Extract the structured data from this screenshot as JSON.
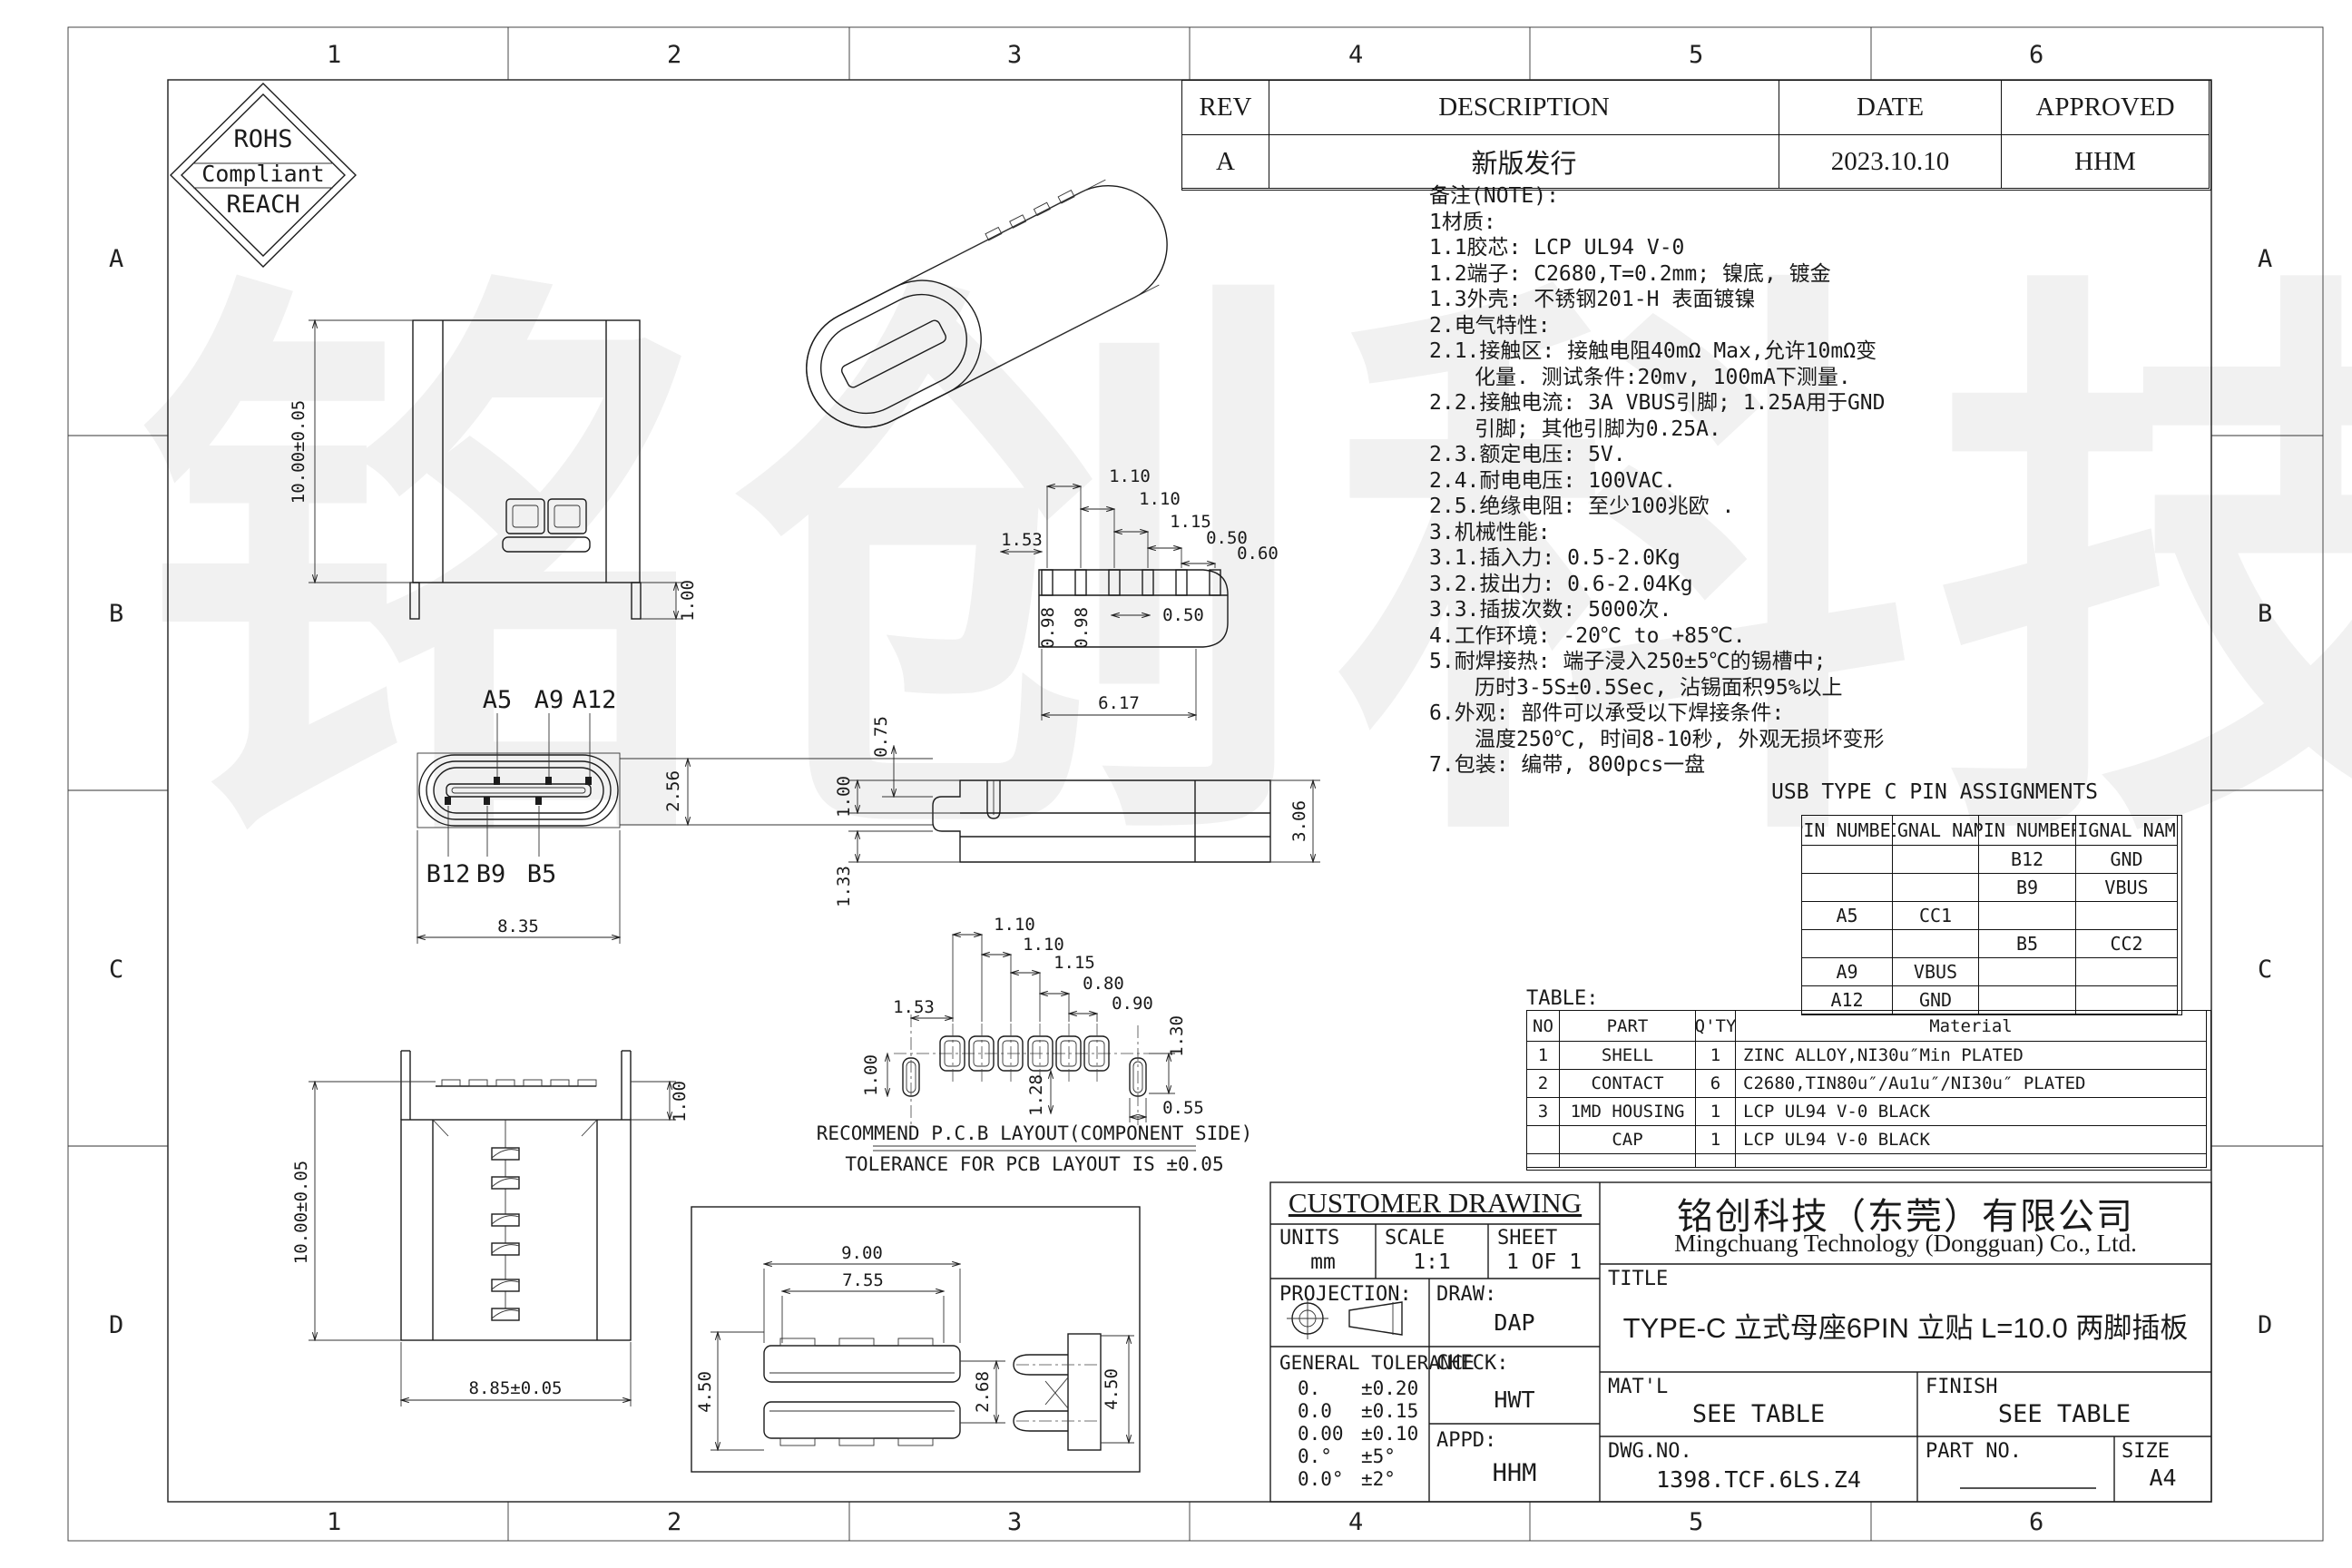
{
  "watermark": "铭创科技",
  "border": {
    "cols": [
      "1",
      "2",
      "3",
      "4",
      "5",
      "6"
    ],
    "rows": [
      "A",
      "B",
      "C",
      "D"
    ]
  },
  "logo": {
    "line1": "ROHS",
    "line2": "Compliant",
    "line3": "REACH"
  },
  "rev_table": {
    "headers": [
      "REV",
      "DESCRIPTION",
      "DATE",
      "APPROVED"
    ],
    "row": {
      "rev": "A",
      "description": "新版发行",
      "date": "2023.10.10",
      "approved": "HHM"
    }
  },
  "notes": {
    "lines": [
      "备注(NOTE):",
      "1材质:",
      "1.1胶芯: LCP UL94 V-0",
      "1.2端子: C2680,T=0.2mm; 镍底, 镀金",
      "1.3外壳: 不锈钢201-H 表面镀镍",
      "2.电气特性:",
      "2.1.接触区: 接触电阻40mΩ Max,允许10mΩ变",
      "化量. 测试条件:20mv, 100mA下测量.",
      "2.2.接触电流: 3A VBUS引脚; 1.25A用于GND",
      "引脚; 其他引脚为0.25A.",
      "2.3.额定电压: 5V.",
      "2.4.耐电电压: 100VAC.",
      "2.5.绝缘电阻: 至少100兆欧 .",
      "3.机械性能:",
      "3.1.插入力: 0.5-2.0Kg",
      "3.2.拔出力: 0.6-2.04Kg",
      "3.3.插拔次数: 5000次.",
      "4.工作环境: -20℃ to +85℃.",
      "5.耐焊接热: 端子浸入250±5℃的锡槽中;",
      "历时3-5S±0.5Sec, 沾锡面积95%以上",
      "6.外观: 部件可以承受以下焊接条件:",
      "温度250℃, 时间8-10秒, 外观无损坏变形",
      "7.包装: 编带, 800pcs一盘"
    ]
  },
  "pin_table": {
    "title": "USB TYPE C PIN ASSIGNMENTS",
    "headers": [
      "PIN NUMBER",
      "SIGNAL NAME",
      "PIN NUMBER",
      "SIGNAL NAME"
    ],
    "rows": [
      [
        "",
        "",
        "B12",
        "GND"
      ],
      [
        "",
        "",
        "B9",
        "VBUS"
      ],
      [
        "A5",
        "CC1",
        "",
        ""
      ],
      [
        "",
        "",
        "B5",
        "CC2"
      ],
      [
        "A9",
        "VBUS",
        "",
        ""
      ],
      [
        "A12",
        "GND",
        "",
        ""
      ]
    ]
  },
  "material_table": {
    "label": "TABLE:",
    "headers": [
      "NO",
      "PART",
      "Q'TY",
      "Material"
    ],
    "rows": [
      [
        "1",
        "SHELL",
        "1",
        "ZINC ALLOY,NI30u″Min PLATED"
      ],
      [
        "2",
        "CONTACT",
        "6",
        "C2680,TIN80u″/Au1u″/NI30u″ PLATED"
      ],
      [
        "3",
        "1MD HOUSING",
        "1",
        "LCP UL94 V-0 BLACK"
      ],
      [
        "",
        "CAP",
        "1",
        "LCP UL94 V-0 BLACK"
      ]
    ]
  },
  "title_block": {
    "customer_drawing": "CUSTOMER DRAWING",
    "units_label": "UNITS",
    "units_value": "mm",
    "scale_label": "SCALE",
    "scale_value": "1:1",
    "sheet_label": "SHEET",
    "sheet_value": "1 OF 1",
    "projection_label": "PROJECTION:",
    "draw_label": "DRAW:",
    "draw_value": "DAP",
    "check_label": "CHECK:",
    "check_value": "HWT",
    "appd_label": "APPD:",
    "appd_value": "HHM",
    "tolerance_label": "GENERAL TOLERANCE",
    "tolerance_rows": [
      [
        "0.",
        "±0.20"
      ],
      [
        "0.0",
        "±0.15"
      ],
      [
        "0.00",
        "±0.10"
      ],
      [
        "0.°",
        "±5°"
      ],
      [
        "0.0°",
        "±2°"
      ]
    ],
    "company_cn": "铭创科技（东莞）有限公司",
    "company_en": "Mingchuang Technology (Dongguan) Co., Ltd.",
    "title_label": "TITLE",
    "title_value": "TYPE-C 立式母座6PIN 立贴 L=10.0 两脚插板",
    "matl_label": "MAT'L",
    "matl_value": "SEE TABLE",
    "finish_label": "FINISH",
    "finish_value": "SEE TABLE",
    "dwgno_label": "DWG.NO.",
    "dwgno_value": "1398.TCF.6LS.Z4",
    "partno_label": "PART NO.",
    "size_label": "SIZE",
    "size_value": "A4"
  },
  "views": {
    "elevation": {
      "height": "10.00±0.05",
      "leg": "1.00"
    },
    "bottom": {
      "d1": "1.53",
      "d2": "1.10",
      "d3": "1.10",
      "d4": "1.15",
      "d5": "0.50",
      "d6": "0.60",
      "d7": "0.98",
      "d8": "0.98",
      "d9": "0.50",
      "d10": "6.17"
    },
    "front": {
      "a1": "A5",
      "a2": "A9",
      "a3": "A12",
      "b1": "B12",
      "b2": "B9",
      "b3": "B5",
      "w": "8.35",
      "h": "2.56"
    },
    "side": {
      "d1": "1.00",
      "d2": "0.75",
      "d3": "1.33",
      "d4": "3.06"
    },
    "pcb": {
      "d1": "1.53",
      "d2": "1.10",
      "d3": "1.10",
      "d4": "1.15",
      "d5": "0.80",
      "d6": "0.90",
      "d7": "1.30",
      "d8": "1.28",
      "d9": "1.00",
      "d10": "0.55",
      "note1": "RECOMMEND P.C.B LAYOUT(COMPONENT SIDE)",
      "note2": "TOLERANCE FOR PCB LAYOUT IS ±0.05"
    },
    "rear": {
      "h": "10.00±0.05",
      "t": "1.00",
      "w": "8.85±0.05"
    },
    "detail": {
      "d1": "9.00",
      "d2": "7.55",
      "d3": "4.50",
      "d4": "2.68",
      "d5": "4.50"
    }
  }
}
